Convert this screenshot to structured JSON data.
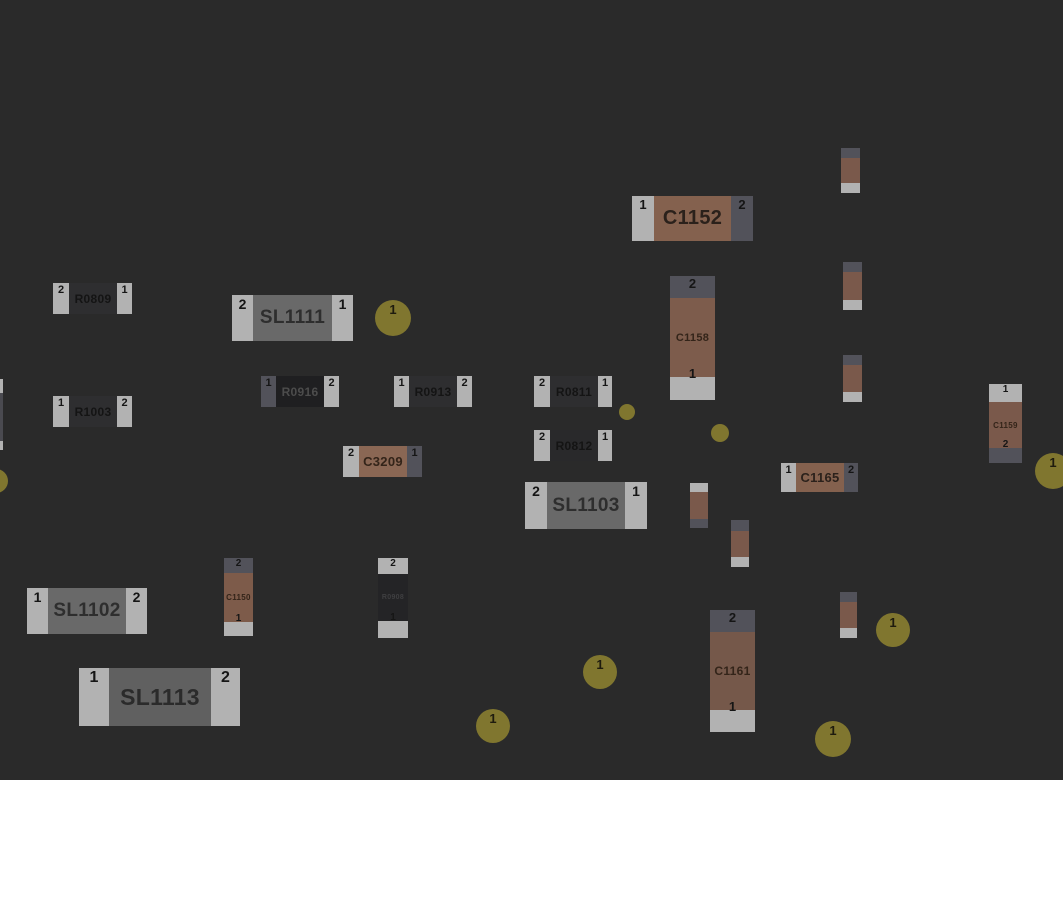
{
  "colors": {
    "background": "#2a2a2a",
    "page": "#ffffff",
    "pad_light": "#b2b2b2",
    "pad_dark": "#52525a",
    "via": "#80762f",
    "num_text": "#151515"
  },
  "board": {
    "width": 1063,
    "height": 780,
    "components": [
      {
        "ref": "C1152",
        "orient": "h",
        "x": 632,
        "y": 196,
        "w": 121,
        "h": 45,
        "body": "#84614e",
        "label_color": "#2b211b",
        "label_size": 20,
        "num_size": 13,
        "pads": [
          {
            "num": "1",
            "tone": "light",
            "size": 22
          },
          {
            "num": "2",
            "tone": "dark",
            "size": 22
          }
        ]
      },
      {
        "ref": "R0809",
        "orient": "h",
        "x": 53,
        "y": 283,
        "w": 79,
        "h": 31,
        "body": "#2e2e30",
        "label_color": "#141414",
        "label_size": 12,
        "num_size": 11,
        "pads": [
          {
            "num": "2",
            "tone": "light",
            "size": 16
          },
          {
            "num": "1",
            "tone": "light",
            "size": 15
          }
        ]
      },
      {
        "ref": "SL1111",
        "orient": "h",
        "x": 232,
        "y": 295,
        "w": 121,
        "h": 46,
        "body": "#696969",
        "label_color": "#2e2e2e",
        "label_size": 19,
        "num_size": 14,
        "pads": [
          {
            "num": "2",
            "tone": "light",
            "size": 21
          },
          {
            "num": "1",
            "tone": "light",
            "size": 21
          }
        ]
      },
      {
        "ref": "R1003",
        "orient": "h",
        "x": 53,
        "y": 396,
        "w": 79,
        "h": 31,
        "body": "#2e2e30",
        "label_color": "#141414",
        "label_size": 12,
        "num_size": 11,
        "pads": [
          {
            "num": "1",
            "tone": "light",
            "size": 16
          },
          {
            "num": "2",
            "tone": "light",
            "size": 15
          }
        ]
      },
      {
        "ref": "R0916",
        "orient": "h",
        "x": 261,
        "y": 376,
        "w": 78,
        "h": 31,
        "body": "#1f1f21",
        "label_color": "#4c4c4c",
        "label_size": 12,
        "num_size": 11,
        "pads": [
          {
            "num": "1",
            "tone": "dark",
            "size": 15
          },
          {
            "num": "2",
            "tone": "light",
            "size": 15
          }
        ]
      },
      {
        "ref": "R0913",
        "orient": "h",
        "x": 394,
        "y": 376,
        "w": 78,
        "h": 31,
        "body": "#2e2e30",
        "label_color": "#141414",
        "label_size": 12,
        "num_size": 11,
        "pads": [
          {
            "num": "1",
            "tone": "light",
            "size": 15
          },
          {
            "num": "2",
            "tone": "light",
            "size": 15
          }
        ]
      },
      {
        "ref": "R0811",
        "orient": "h",
        "x": 534,
        "y": 376,
        "w": 78,
        "h": 31,
        "body": "#2e2e30",
        "label_color": "#141414",
        "label_size": 12,
        "num_size": 11,
        "pads": [
          {
            "num": "2",
            "tone": "light",
            "size": 16
          },
          {
            "num": "1",
            "tone": "light",
            "size": 14
          }
        ]
      },
      {
        "ref": "R0812",
        "orient": "h",
        "x": 534,
        "y": 430,
        "w": 78,
        "h": 31,
        "body": "#29292b",
        "label_color": "#141414",
        "label_size": 12,
        "num_size": 11,
        "pads": [
          {
            "num": "2",
            "tone": "light",
            "size": 16
          },
          {
            "num": "1",
            "tone": "light",
            "size": 14
          }
        ]
      },
      {
        "ref": "C3209",
        "orient": "h",
        "x": 343,
        "y": 446,
        "w": 79,
        "h": 31,
        "body": "#8a6754",
        "label_color": "#332419",
        "label_size": 13,
        "num_size": 11,
        "pads": [
          {
            "num": "2",
            "tone": "light",
            "size": 16
          },
          {
            "num": "1",
            "tone": "dark",
            "size": 15
          }
        ]
      },
      {
        "ref": "SL1103",
        "orient": "h",
        "x": 525,
        "y": 482,
        "w": 122,
        "h": 47,
        "body": "#696969",
        "label_color": "#2e2e2e",
        "label_size": 19,
        "num_size": 14,
        "pads": [
          {
            "num": "2",
            "tone": "light",
            "size": 22
          },
          {
            "num": "1",
            "tone": "light",
            "size": 22
          }
        ]
      },
      {
        "ref": "C1165",
        "orient": "h",
        "x": 781,
        "y": 463,
        "w": 77,
        "h": 29,
        "body": "#84614e",
        "label_color": "#2b211b",
        "label_size": 13,
        "num_size": 11,
        "pads": [
          {
            "num": "1",
            "tone": "light",
            "size": 15
          },
          {
            "num": "2",
            "tone": "dark",
            "size": 14
          }
        ]
      },
      {
        "ref": "SL1102",
        "orient": "h",
        "x": 27,
        "y": 588,
        "w": 120,
        "h": 46,
        "body": "#696969",
        "label_color": "#2e2e2e",
        "label_size": 19,
        "num_size": 14,
        "pads": [
          {
            "num": "1",
            "tone": "light",
            "size": 21
          },
          {
            "num": "2",
            "tone": "light",
            "size": 21
          }
        ]
      },
      {
        "ref": "SL1113",
        "orient": "h",
        "x": 79,
        "y": 668,
        "w": 161,
        "h": 58,
        "body": "#606060",
        "label_color": "#2b2b2b",
        "label_size": 23,
        "num_size": 16,
        "pads": [
          {
            "num": "1",
            "tone": "light",
            "size": 30
          },
          {
            "num": "2",
            "tone": "light",
            "size": 29
          }
        ]
      },
      {
        "ref": "C1158",
        "orient": "v",
        "x": 670,
        "y": 276,
        "w": 45,
        "h": 124,
        "body": "#7d5c4c",
        "label_color": "#332419",
        "label_size": 11,
        "num_size": 13,
        "pads": [
          {
            "num": "2",
            "tone": "dark",
            "size": 22
          },
          {
            "num": "1",
            "tone": "light",
            "size": 23
          }
        ]
      },
      {
        "ref": "C1161",
        "orient": "v",
        "x": 710,
        "y": 610,
        "w": 45,
        "h": 122,
        "body": "#75584a",
        "label_color": "#332419",
        "label_size": 12,
        "num_size": 13,
        "pads": [
          {
            "num": "2",
            "tone": "dark",
            "size": 22
          },
          {
            "num": "1",
            "tone": "light",
            "size": 22
          }
        ]
      },
      {
        "ref": "C1159",
        "orient": "v",
        "x": 989,
        "y": 384,
        "w": 33,
        "h": 79,
        "body": "#7a594b",
        "label_color": "#332419",
        "label_size": 8,
        "num_size": 10,
        "pads": [
          {
            "num": "1",
            "tone": "light",
            "size": 18
          },
          {
            "num": "2",
            "tone": "dark",
            "size": 15
          }
        ]
      },
      {
        "ref": "C1150",
        "orient": "v",
        "x": 224,
        "y": 558,
        "w": 29,
        "h": 78,
        "body": "#7d5b4a",
        "label_color": "#332419",
        "label_size": 8,
        "num_size": 10,
        "pads": [
          {
            "num": "2",
            "tone": "dark",
            "size": 15
          },
          {
            "num": "1",
            "tone": "light",
            "size": 14
          }
        ]
      },
      {
        "ref": "R0908",
        "orient": "v",
        "x": 378,
        "y": 558,
        "w": 30,
        "h": 80,
        "body": "#242426",
        "label_color": "#3f3f41",
        "label_size": 7,
        "num_size": 10,
        "pads": [
          {
            "num": "2",
            "tone": "light",
            "size": 16
          },
          {
            "num": "1",
            "tone": "light",
            "size": 17
          }
        ]
      },
      {
        "ref": "",
        "orient": "v",
        "x": 841,
        "y": 148,
        "w": 19,
        "h": 45,
        "body": "#7a594b",
        "label_color": "",
        "label_size": 0,
        "num_size": 0,
        "pads": [
          {
            "num": "",
            "tone": "dark",
            "size": 10
          },
          {
            "num": "",
            "tone": "light",
            "size": 10
          }
        ]
      },
      {
        "ref": "",
        "orient": "v",
        "x": 843,
        "y": 262,
        "w": 19,
        "h": 48,
        "body": "#7a594b",
        "label_color": "",
        "label_size": 0,
        "num_size": 0,
        "pads": [
          {
            "num": "",
            "tone": "dark",
            "size": 10
          },
          {
            "num": "",
            "tone": "light",
            "size": 10
          }
        ]
      },
      {
        "ref": "",
        "orient": "v",
        "x": 843,
        "y": 355,
        "w": 19,
        "h": 47,
        "body": "#7a594b",
        "label_color": "",
        "label_size": 0,
        "num_size": 0,
        "pads": [
          {
            "num": "",
            "tone": "dark",
            "size": 10
          },
          {
            "num": "",
            "tone": "light",
            "size": 10
          }
        ]
      },
      {
        "ref": "",
        "orient": "v",
        "x": 840,
        "y": 592,
        "w": 17,
        "h": 46,
        "body": "#7a594b",
        "label_color": "",
        "label_size": 0,
        "num_size": 0,
        "pads": [
          {
            "num": "",
            "tone": "dark",
            "size": 10
          },
          {
            "num": "",
            "tone": "light",
            "size": 10
          }
        ]
      },
      {
        "ref": "",
        "orient": "v",
        "x": 690,
        "y": 483,
        "w": 18,
        "h": 45,
        "body": "#7a594b",
        "label_color": "",
        "label_size": 0,
        "num_size": 0,
        "pads": [
          {
            "num": "",
            "tone": "light",
            "size": 9
          },
          {
            "num": "",
            "tone": "dark",
            "size": 9
          }
        ]
      },
      {
        "ref": "",
        "orient": "v",
        "x": 731,
        "y": 520,
        "w": 18,
        "h": 47,
        "body": "#7a594b",
        "label_color": "",
        "label_size": 0,
        "num_size": 0,
        "pads": [
          {
            "num": "",
            "tone": "dark",
            "size": 11
          },
          {
            "num": "",
            "tone": "light",
            "size": 10
          }
        ]
      },
      {
        "ref": "",
        "orient": "v",
        "x": 0,
        "y": 379,
        "w": 3,
        "h": 71,
        "body": "#4a4a50",
        "label_color": "",
        "label_size": 0,
        "num_size": 0,
        "pads": [
          {
            "num": "",
            "tone": "light",
            "size": 14
          },
          {
            "num": "",
            "tone": "light",
            "size": 9
          }
        ]
      }
    ],
    "vias": [
      {
        "x": 393,
        "y": 318,
        "r": 18,
        "label": "1"
      },
      {
        "x": 627,
        "y": 412,
        "r": 8,
        "label": ""
      },
      {
        "x": 720,
        "y": 433,
        "r": 9,
        "label": ""
      },
      {
        "x": 1053,
        "y": 471,
        "r": 18,
        "label": "1"
      },
      {
        "x": 600,
        "y": 672,
        "r": 17,
        "label": "1"
      },
      {
        "x": 893,
        "y": 630,
        "r": 17,
        "label": "1"
      },
      {
        "x": 833,
        "y": 739,
        "r": 18,
        "label": "1"
      },
      {
        "x": 493,
        "y": 726,
        "r": 17,
        "label": "1"
      },
      {
        "x": -4,
        "y": 481,
        "r": 12,
        "label": ""
      }
    ]
  }
}
